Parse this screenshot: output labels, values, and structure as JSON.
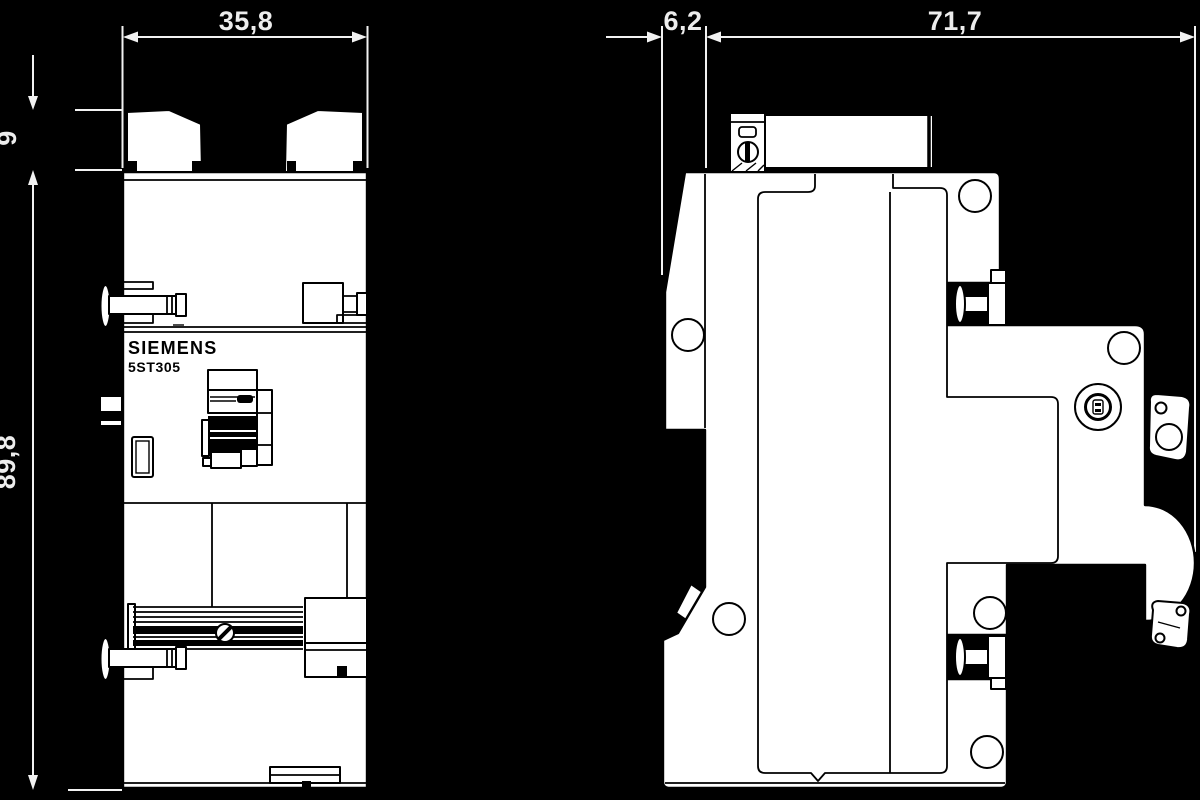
{
  "drawing": {
    "brand_label": "SIEMENS",
    "model_label": "5ST305",
    "dimensions": {
      "front_width": "35,8",
      "clip_height": "9",
      "total_height": "89,8",
      "rail_offset": "6,2",
      "depth": "71,7"
    },
    "colors": {
      "background": "#000000",
      "annotation": "#f2f2f2",
      "body_fill": "#ffffff",
      "line_art": "#000000"
    },
    "views": [
      "front-view",
      "side-view"
    ]
  }
}
